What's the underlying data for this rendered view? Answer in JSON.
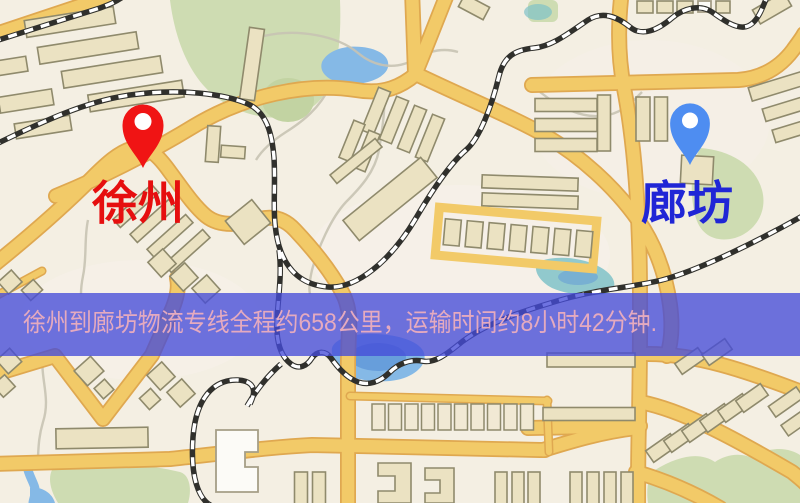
{
  "markers": [
    {
      "id": "xuzhou",
      "label": "徐州"
    },
    {
      "id": "langfang",
      "label": "廊坊"
    }
  ],
  "banner": {
    "text": "徐州到廊坊物流专线全程约658公里，运输时间约8小时42分钟."
  },
  "palette": {
    "background": "#f4efe3",
    "tint": "#f8f1ec",
    "park": "#cedcb2",
    "park_dark": "#c2d3a2",
    "water": "#85b9e6",
    "water_deep": "#5f97d8",
    "water_teal": "#7fc2c8",
    "minor_path": "#c8c3b2",
    "road_fill": "#f2ca68",
    "road_edge": "#dfa850",
    "rail_dark": "#30302c",
    "rail_light": "#ffffff",
    "building_fill": "#ebe2c2",
    "building_light": "#f1e9d4",
    "building_stroke": "#8f8a6c",
    "building_white": "#fcfbf7",
    "building_white_stroke": "#a59e87",
    "pin_xuzhou": "#f01414",
    "pin_langfang": "#4e8df1",
    "pin_hole": "#ffffff",
    "label_xuzhou": "#e60f0f",
    "label_langfang": "#2026d6",
    "banner_bg": "rgba(69,76,216,0.78)",
    "banner_text": "#e5aabf"
  }
}
